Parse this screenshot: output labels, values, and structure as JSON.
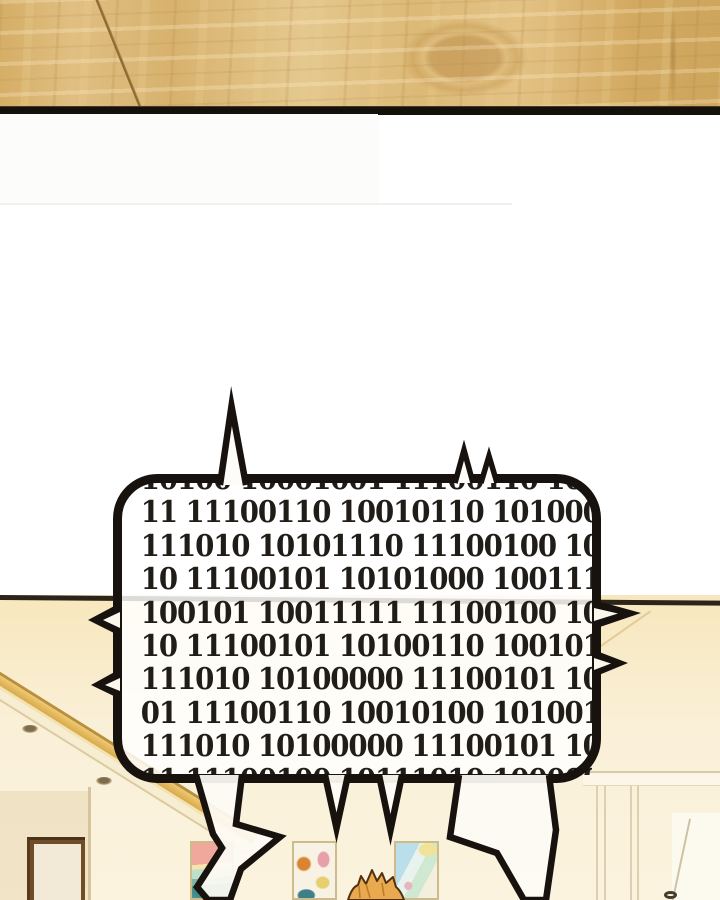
{
  "panel": {
    "type_label": "comic-panel",
    "top_panel": "wood-floor",
    "bottom_scene": "room-interior"
  },
  "bubble": {
    "shape": "spiked-rounded-rect-with-lightning-tails",
    "lines": [
      "10100 10001001 11100110 10",
      "11 11100110 10010110 1010000",
      "111010 10101110 11100100 101",
      "10 11100101 10101000 1001110",
      "100101 10011111 11100100 101",
      "10 11100101 10100110 1001011",
      "111010 10100000 11100101 101",
      "01 11100110 10010100 1010010",
      "111010 10100000 11100101 101",
      "11 11100100 10111010 1000001"
    ]
  },
  "scene": {
    "wall": "cream",
    "molding": "gold-cornice",
    "frames_count": 3,
    "door": "white-door-right",
    "mirror": "brown-framed-mirror-left",
    "character": "spiky-golden-hair-top-of-head"
  },
  "colors": {
    "wood_base": "#dcb977",
    "wood_border": "#14100a",
    "wall_cream": "#f8ebc8",
    "molding_gold": "#e2b458",
    "bubble_outline": "#17120e",
    "bubble_fill": "rgba(255,255,255,0.84)",
    "binary_text": "#201d19",
    "hair": "#e9a94f"
  }
}
